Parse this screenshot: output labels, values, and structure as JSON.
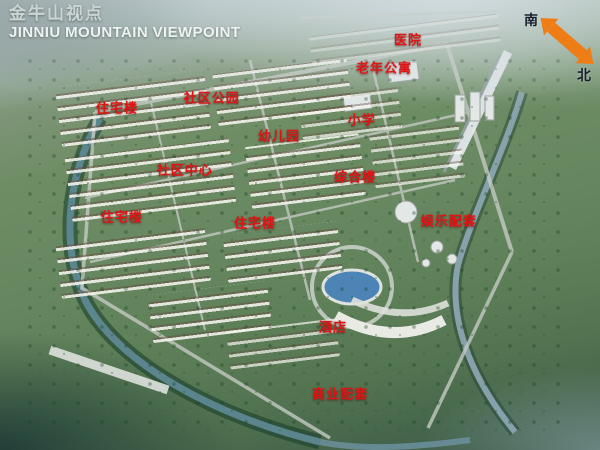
{
  "header": {
    "title_cn": "金牛山视点",
    "title_en": "JINNIU MOUNTAIN VIEWPOINT"
  },
  "compass": {
    "south_label": "南",
    "north_label": "北",
    "arrow_color": "#ee7d15"
  },
  "map": {
    "label_color": "#e11414",
    "labels": [
      {
        "id": "hospital",
        "text": "医院"
      },
      {
        "id": "senior-apartments",
        "text": "老年公寓"
      },
      {
        "id": "residential-1",
        "text": "住宅楼"
      },
      {
        "id": "community-park",
        "text": "社区公园"
      },
      {
        "id": "kindergarten",
        "text": "幼儿园"
      },
      {
        "id": "primary-school",
        "text": "小学"
      },
      {
        "id": "community-center",
        "text": "社区中心"
      },
      {
        "id": "complex-building",
        "text": "综合楼"
      },
      {
        "id": "residential-2",
        "text": "住宅楼"
      },
      {
        "id": "residential-3",
        "text": "住宅楼"
      },
      {
        "id": "entertainment",
        "text": "娱乐配套"
      },
      {
        "id": "hotel",
        "text": "酒店"
      },
      {
        "id": "commercial",
        "text": "商业配套"
      }
    ]
  }
}
